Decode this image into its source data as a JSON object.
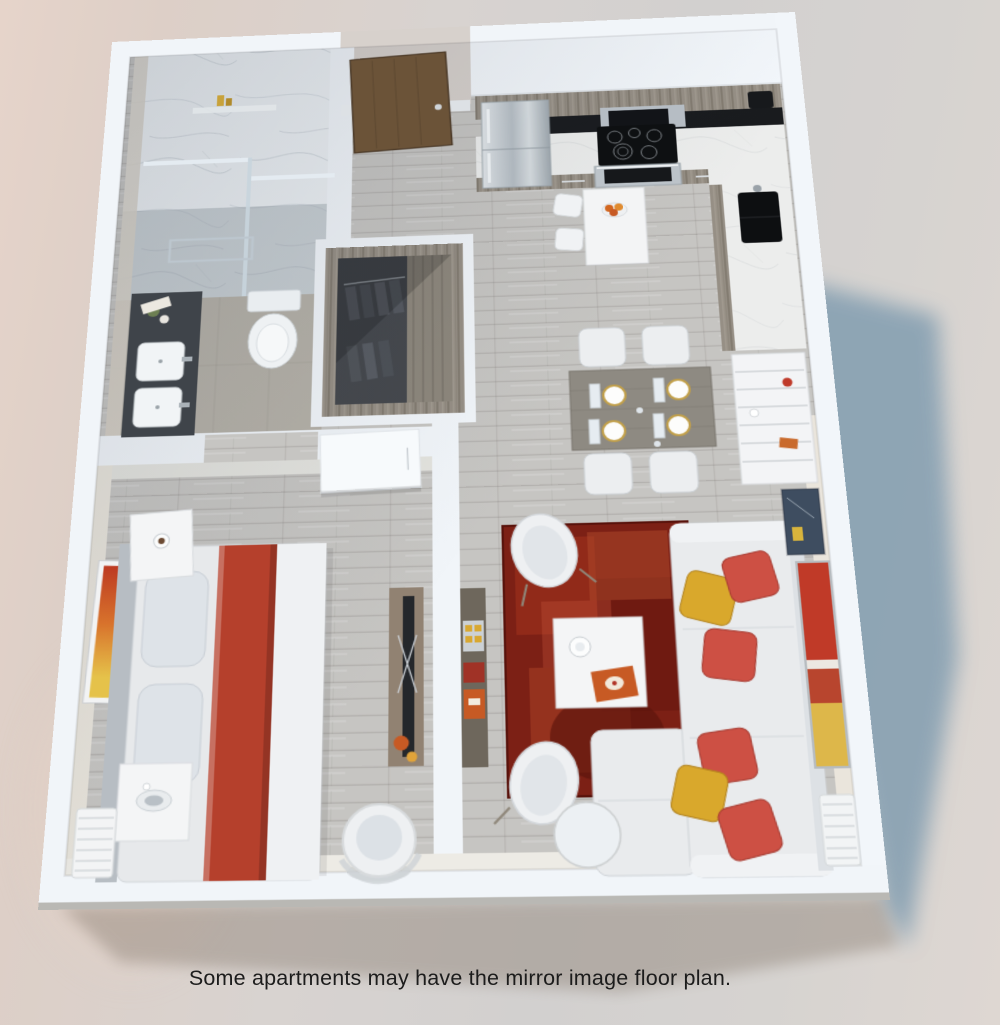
{
  "caption": "Some apartments may have the mirror image floor plan.",
  "scene": {
    "type": "3d-floor-plan-rendering",
    "view": "isometric top-down dollhouse view of a one-bedroom apartment",
    "rooms": [
      {
        "name": "bathroom",
        "position": "top-left",
        "items": [
          "marble walk-in shower",
          "glass partition",
          "towel bar",
          "toilet",
          "dark double-sink vanity"
        ]
      },
      {
        "name": "entry",
        "position": "top-center",
        "items": [
          "wood entry door",
          "hallway"
        ]
      },
      {
        "name": "walk-in-closet",
        "position": "center-left",
        "items": [
          "hanging clothes",
          "wood-lined walls",
          "shelving"
        ]
      },
      {
        "name": "kitchen",
        "position": "top-right",
        "items": [
          "refrigerator",
          "microwave",
          "cooktop",
          "oven",
          "marble counters",
          "black sink",
          "coffee maker",
          "counter-height table with two stools",
          "fruit plate"
        ]
      },
      {
        "name": "dining-area",
        "position": "center-right",
        "items": [
          "gray wood dining table",
          "four white chairs",
          "four gold-rim place settings",
          "white shelving unit"
        ]
      },
      {
        "name": "living-room",
        "position": "bottom-right",
        "items": [
          "white sectional sofa",
          "red and yellow pillows",
          "dark red area rug",
          "white coffee table with mug and magazine",
          "two white armchairs",
          "round marble side table",
          "two wall artworks",
          "radiator",
          "sideboard"
        ]
      },
      {
        "name": "bedroom",
        "position": "bottom-left",
        "items": [
          "bed with red runner",
          "headboard",
          "nightstand",
          "leaning artwork",
          "foot-of-bed table with bowl",
          "radiator",
          "TV console with orange vases",
          "round rattan lounge chair",
          "white sliding door"
        ]
      }
    ]
  },
  "colors": {
    "background_left": "#e6d4ca",
    "background_mid": "#d6d2d0",
    "cast_shadow": "#7d9aae",
    "under_shadow": "#8d8176",
    "wall": "#f1f5f9",
    "wall_face": "#e8e4dc",
    "floor_plank": "#c6c5c2",
    "bathroom_floor": "#b5b1a8",
    "marble": "#ecf0f3",
    "cabinet_wood": "#968f85",
    "counter_marble": "#ebe9e4",
    "appliance_black": "#15171a",
    "stainless": "#b9c0c6",
    "vanity": "#3f444a",
    "entry_door": "#6b5338",
    "closet_interior": "#45484d",
    "dining_table": "#8e8a82",
    "rug": "#7c2015",
    "sofa": "#e9ebed",
    "accent_red": "#cd5044",
    "accent_yellow": "#d9a82c",
    "bed_runner": "#b5402c",
    "orange_decor": "#c75a24",
    "caption_text": "#1c1c1c"
  }
}
